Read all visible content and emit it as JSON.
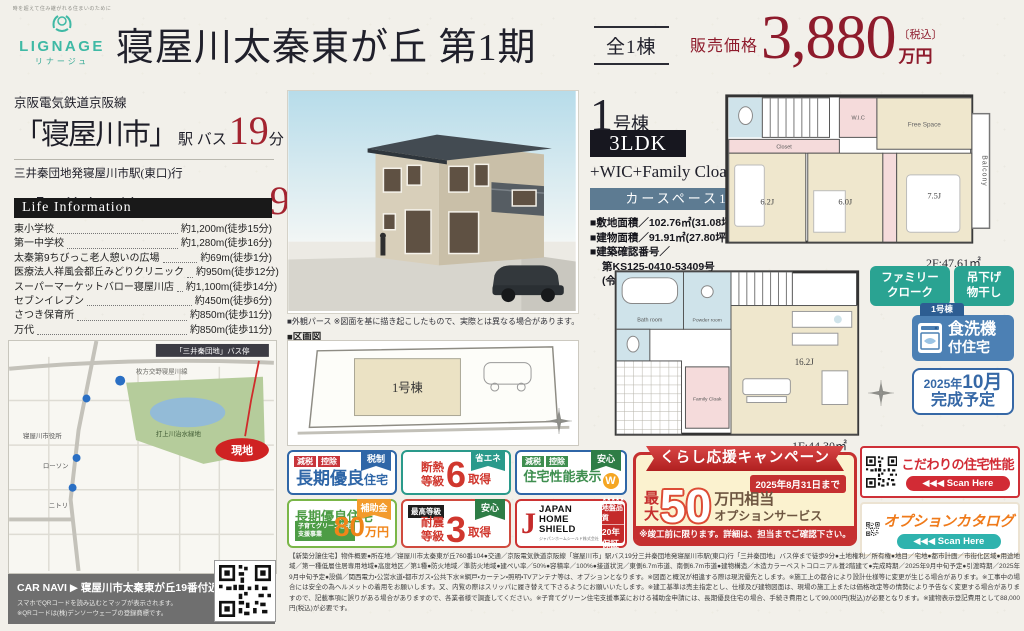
{
  "header": {
    "tagline": "時を超えて住み継がれる住まいのために",
    "logo_name": "LIGNAGE",
    "logo_furigana": "リナージュ",
    "title": "寝屋川太秦東が丘 第1期",
    "units_badge": "全1棟",
    "price_label": "販売価格",
    "price_value": "3,880",
    "price_tax": "〔税込〕",
    "price_unit": "万円"
  },
  "access": {
    "rail_line": "京阪電気鉄道京阪線",
    "station": "「寝屋川市」",
    "station_mode": "駅 バス",
    "station_minutes": "19",
    "station_minutes_unit": "分",
    "bus_route": "三井秦団地発寝屋川市駅(東口)行",
    "bus_stop": "「三井秦団地」",
    "bus_mode": "バス停まで 徒歩",
    "bus_minutes": "9",
    "bus_minutes_unit": "分"
  },
  "life_information": {
    "title": "Life Information",
    "items": [
      {
        "name": "東小学校",
        "distance": "約1,200m(徒歩15分)"
      },
      {
        "name": "第一中学校",
        "distance": "約1,280m(徒歩16分)"
      },
      {
        "name": "太秦第9ちびっこ老人憩いの広場",
        "distance": "約69m(徒歩1分)"
      },
      {
        "name": "医療法人祥風会都丘みどりクリニック",
        "distance": "約950m(徒歩12分)"
      },
      {
        "name": "スーパーマーケットバロー寝屋川店",
        "distance": "約1,100m(徒歩14分)"
      },
      {
        "name": "セブンイレブン",
        "distance": "約450m(徒歩6分)"
      },
      {
        "name": "さつき保育所",
        "distance": "約850m(徒歩11分)"
      },
      {
        "name": "万代",
        "distance": "約850m(徒歩11分)"
      }
    ]
  },
  "map": {
    "bus_stop_tag": "「三井秦団地」バス停",
    "road_label": "枚方交野寝屋川線",
    "park_label": "打上川治水緑地",
    "poi1": "ローソン",
    "poi2": "ニトリ",
    "poi3": "寝屋川市役所",
    "site_marker": "現地"
  },
  "car_navi": {
    "label": "CAR NAVI ▶",
    "destination": "寝屋川市太秦東が丘19番付近",
    "note1": "スマホでQRコードを読み込むとマップが表示されます。",
    "note2": "※QRコードは(株)デンソーウェーブの登録商標です。"
  },
  "exterior": {
    "caption": "■外観パース ※図面を基に描き起こしたもので、実際とは異なる場合があります。",
    "siteplan_label": "■区画図",
    "siteplan_unit": "1号棟"
  },
  "unit": {
    "number": "1",
    "number_suffix": "号棟",
    "plan_type": "3LDK",
    "plan_extra": "+WIC+Family Cloak",
    "car_space": "カースペース1台",
    "land_area": "■敷地面積／102.76㎡(31.08坪)",
    "building_area": "■建物面積／91.91㎡(27.80坪)",
    "confirmation_label": "■建築確認番号／",
    "confirmation_no": "第KS125-0410-53409号",
    "confirmation_date": "(令和7年3月31日)"
  },
  "floorplan_2f": {
    "closet": "Closet",
    "wic": "W.I.C",
    "free_space": "Free Space",
    "balcony": "Balcony",
    "room1": "6.2J",
    "room2": "6.0J",
    "room3": "7.5J",
    "dn": "DN",
    "area": "2F:47.61㎡"
  },
  "floorplan_1f": {
    "bath": "Bath room",
    "powder": "Powder room",
    "family_cloak": "Family Cloak",
    "ldk": "16.2J",
    "up": "UP",
    "area": "1F:44.30㎡"
  },
  "feature_tags": {
    "tag1_line1": "ファミリー",
    "tag1_line2": "クローク",
    "tag2_line1": "吊下げ",
    "tag2_line2": "物干し"
  },
  "dishwasher_badge": {
    "unit": "1号棟",
    "line1": "食洗機",
    "line2": "付住宅"
  },
  "completion_badge": {
    "line1_small": "2025年",
    "line1_big": "10月",
    "line2": "完成予定"
  },
  "perf_badges": {
    "b1": {
      "tag1": "減税",
      "tag2": "控除",
      "ribbon": "税制",
      "main": "長期優良",
      "suffix": "住宅"
    },
    "b2": {
      "line1": "断熱",
      "line2": "等級",
      "big": "6",
      "suffix": "取得",
      "ribbon": "省エネ"
    },
    "b3": {
      "tag1": "減税",
      "tag2": "控除",
      "ribbon": "安心",
      "main": "住宅性能表示",
      "w": "W"
    },
    "b4": {
      "main": "長期優良住宅",
      "ribbon": "補助金",
      "program1": "子育てグリーン住宅",
      "program2": "支援事業",
      "amount": "80",
      "unit": "万円"
    },
    "b5": {
      "top": "最高等級",
      "line1": "耐震",
      "line2": "等級",
      "big": "3",
      "suffix": "取得",
      "ribbon": "安心"
    },
    "b6": {
      "j": "J",
      "name1": "JAPAN",
      "name2": "HOME",
      "name3": "SHIELD",
      "note": "ジャパンホームシールド株式会社",
      "stars": "★★★★★",
      "quality": "地盤品質",
      "warranty": "20年保証"
    }
  },
  "campaign": {
    "ribbon": "くらし応援キャンペーン",
    "deadline": "2025年8月31日まで",
    "max1": "最",
    "max2": "大",
    "amount": "50",
    "suffix1": "万円相当",
    "suffix2": "オプションサービス",
    "note": "※竣工前に限ります。詳細は、担当までご確認下さい。"
  },
  "qr_cards": {
    "card1": {
      "title": "こだわりの住宅性能",
      "pill": "◀◀◀ Scan Here"
    },
    "card2": {
      "title": "オプションカタログ",
      "pill": "◀◀◀ Scan Here"
    }
  },
  "fine_print": "【新築分譲住宅】物件概要●所在地／寝屋川市太秦東が丘760番104●交通／京阪電気鉄道京阪線「寝屋川市」駅バス19分三井秦団地発寝屋川市駅(東口)行「三井秦団地」バス停まで徒歩9分●土地権利／所有権●地目／宅地●都市計画／市街化区域●用途地域／第一種低層住居専用地域●高度地区／第1種●防火地域／準防火地域●建ぺい率／50%●容積率／100%●接道状況／東側6.7m市道、南側6.7m市道●建物構造／木造カラーベストコロニアル葺2階建て●完成時期／2025年9月中旬予定●引渡時期／2025年9月中旬予定●設備／関西電力・公営水道・都市ガス・公共下水※網戸・カーテン・照明・TVアンテナ等は、オプションとなります。※図面と概況が相違する際は現況優先とします。※施工上の都合により設計仕様等に変更が生じる場合があります。※工事中の場合には安全の為ヘルメットの着用をお願いします。又、内覧の際はスリッパに履き替えて下さるようにお願いいたします。※建工基準は売主指定とし、仕様及び建物図面は、現場の施工上または価格改定等の情勢により予告なく変更する場合がありますので、記載事項に誤りがある場合がありますので、各業者様で調査してください。※子育てグリーン住宅支援事業における補助金申請には、長期優良住宅の場合、手続き費用として99,000円(税込)が必要となります。※建物表示登記費用として88,000円(税込)が必要です。",
  "colors": {
    "brand_teal": "#3fb9a5",
    "price_red": "#8e1b2c",
    "accent_red": "#c53030",
    "badge_blue": "#2f66a7",
    "badge_teal": "#2a9a8b",
    "badge_green": "#4d9c45",
    "badge_orange": "#f08519",
    "slate_bar": "#5d7b92"
  }
}
